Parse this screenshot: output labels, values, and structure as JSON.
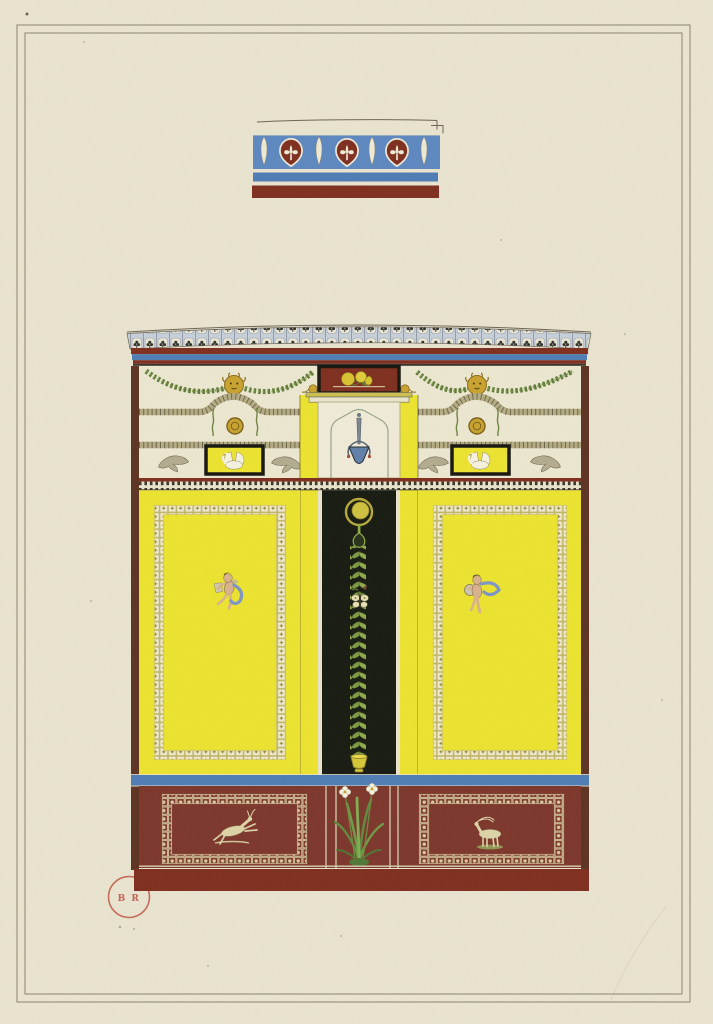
{
  "stamp": {
    "text": "B R"
  },
  "palette": {
    "paper": "#e9e4d0",
    "frame_line": "#8b8269",
    "dark_red": "#7e2d1e",
    "dado_red": "#7c352a",
    "maroon_border": "#5c3222",
    "blue": "#4d7cb5",
    "frieze_blue": "#5b87c0",
    "cream": "#ece7d0",
    "ornament_cream": "#e9e3cc",
    "black_panel": "#15190f",
    "yellow": "#ece32e",
    "gold": "#c9a22e",
    "green": "#5f7a3a",
    "leaf_green": "#7d9a43",
    "ivory": "#f6f2e0",
    "fauna_cream": "#ddd3a8",
    "fauna_grey": "#b3ab90",
    "flesh": "#d9b28c",
    "drapery_blue": "#7c95c4",
    "stamp_red": "#c05243"
  }
}
